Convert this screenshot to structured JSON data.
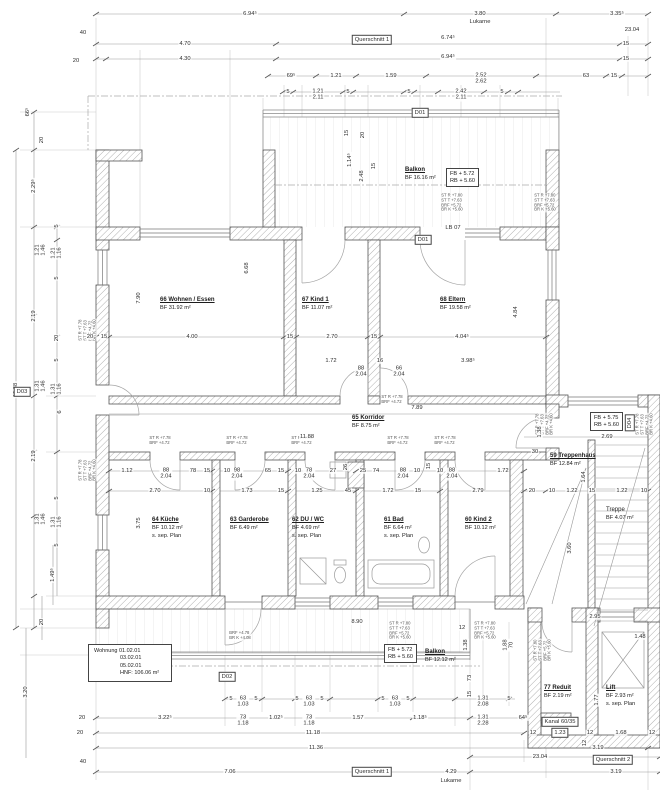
{
  "drawing": {
    "rooms": {
      "balkon_top": {
        "name": "Balkon",
        "area": "BF 16.16 m²"
      },
      "wohnen": {
        "name": "66 Wohnen / Essen",
        "area": "BF 31.92 m²"
      },
      "kind1": {
        "name": "67 Kind 1",
        "area": "BF 11.07 m²"
      },
      "eltern": {
        "name": "68 Eltern",
        "area": "BF 19.58 m²"
      },
      "korridor": {
        "name": "65 Korridor",
        "area": "BF 8.75 m²"
      },
      "kueche": {
        "name": "64 Küche",
        "area": "BF 10.12 m²",
        "note": "s. sep. Plan"
      },
      "garderobe": {
        "name": "63 Garderobe",
        "area": "BF 6.49 m²"
      },
      "duwc": {
        "name": "62 DU / WC",
        "area": "BF 4.69 m²",
        "note": "s. sep. Plan"
      },
      "bad": {
        "name": "61 Bad",
        "area": "BF 6.64 m²",
        "note": "s. sep. Plan"
      },
      "kind2": {
        "name": "60 Kind 2",
        "area": "BF 10.12 m²"
      },
      "treppenhaus": {
        "name": "59 Treppenhaus",
        "area": "BF 12.84 m²"
      },
      "treppe": {
        "name": "Treppe",
        "area": "BF 4.07 m²"
      },
      "balkon_bottom": {
        "name": "Balkon",
        "area": "BF 12.12 m²"
      },
      "reduit": {
        "name": "77 Reduit",
        "area": "BF 2.19 m²"
      },
      "lift": {
        "name": "Lift",
        "area": "BF 2.93 m²",
        "note": "s. sep. Plan"
      }
    },
    "levels": {
      "top": {
        "fb": "FB  + 5.72",
        "rb": "RB  + 5.60"
      },
      "right": {
        "fb": "FB  + 5.75",
        "rb": "RB  + 5.60"
      },
      "bottom": {
        "fb": "FB  + 5.72",
        "rb": "RB  + 5.60"
      }
    },
    "apartment": {
      "l1": "Wohnung  01.02.01",
      "l2": "03.02.01",
      "l3": "05.02.01",
      "l4": "HNF:  106.06 m²"
    },
    "colors": {
      "wall_line": "#555555",
      "hatch": "#8f8f8f",
      "chain": "#9a9a9a",
      "text": "#2e2e2e"
    },
    "dims": [
      {
        "t": "6.94⁵",
        "x": 250,
        "y": 14
      },
      {
        "t": "3.80",
        "x": 480,
        "y": 14
      },
      {
        "t": "Lukarne",
        "x": 480,
        "y": 22
      },
      {
        "t": "3.35⁵",
        "x": 617,
        "y": 14
      },
      {
        "t": "23.04",
        "x": 632,
        "y": 30
      },
      {
        "t": "40",
        "x": 83,
        "y": 33
      },
      {
        "t": "4.70",
        "x": 185,
        "y": 44
      },
      {
        "t": "Querschnitt 1",
        "x": 372,
        "y": 40,
        "box": true
      },
      {
        "t": "6.74⁵",
        "x": 448,
        "y": 38
      },
      {
        "t": "15",
        "x": 626,
        "y": 44
      },
      {
        "t": "20",
        "x": 76,
        "y": 61
      },
      {
        "t": "4.30",
        "x": 185,
        "y": 59
      },
      {
        "t": "6.94⁵",
        "x": 448,
        "y": 57
      },
      {
        "t": "15",
        "x": 626,
        "y": 59
      },
      {
        "t": "69⁵",
        "x": 291,
        "y": 76
      },
      {
        "t": "1.21",
        "x": 336,
        "y": 76
      },
      {
        "t": "1.59",
        "x": 391,
        "y": 76
      },
      {
        "t": "2.52",
        "t2": "2.62",
        "x": 481,
        "y": 79
      },
      {
        "t": "63",
        "x": 586,
        "y": 76
      },
      {
        "t": "15",
        "x": 614,
        "y": 76
      },
      {
        "t": "5",
        "x": 288,
        "y": 92
      },
      {
        "t": "1.21",
        "t2": "2.11",
        "x": 318,
        "y": 95
      },
      {
        "t": "5",
        "x": 348,
        "y": 92
      },
      {
        "t": "5",
        "x": 409,
        "y": 92
      },
      {
        "t": "2.42",
        "t2": "2.11",
        "x": 461,
        "y": 95
      },
      {
        "t": "5",
        "x": 502,
        "y": 92
      },
      {
        "t": "D01",
        "x": 420,
        "y": 113,
        "box": true
      },
      {
        "t": "15",
        "x": 347,
        "y": 133,
        "v": true
      },
      {
        "t": "20",
        "x": 363,
        "y": 135,
        "v": true
      },
      {
        "t": "1.14⁵",
        "x": 350,
        "y": 160,
        "v": true
      },
      {
        "t": "2.48",
        "x": 362,
        "y": 176,
        "v": true
      },
      {
        "t": "15",
        "x": 374,
        "y": 166,
        "v": true
      },
      {
        "t": "LB 07",
        "x": 453,
        "y": 228
      },
      {
        "t": "D01",
        "x": 423,
        "y": 240,
        "box": true
      },
      {
        "t": "66⁵",
        "x": 28,
        "y": 112,
        "v": true
      },
      {
        "t": "20",
        "x": 42,
        "y": 140,
        "v": true
      },
      {
        "t": "2.29⁵",
        "x": 34,
        "y": 186,
        "v": true
      },
      {
        "t": "5",
        "x": 57,
        "y": 226,
        "v": true
      },
      {
        "t": "1.21",
        "t2": "1.46",
        "x": 41,
        "y": 250,
        "v": true
      },
      {
        "t": "1.21",
        "t2": "1.16",
        "x": 57,
        "y": 253,
        "v": true
      },
      {
        "t": "5",
        "x": 57,
        "y": 278,
        "v": true
      },
      {
        "t": "2.19",
        "x": 34,
        "y": 316,
        "v": true
      },
      {
        "t": "12.88",
        "x": 16,
        "y": 390,
        "v": true
      },
      {
        "t": "20",
        "x": 57,
        "y": 338,
        "v": true
      },
      {
        "t": "5",
        "x": 57,
        "y": 360,
        "v": true
      },
      {
        "t": "1.31",
        "t2": "1.46",
        "x": 41,
        "y": 386,
        "v": true
      },
      {
        "t": "1.31",
        "t2": "1.16",
        "x": 57,
        "y": 389,
        "v": true
      },
      {
        "t": "D03",
        "x": 22,
        "y": 392,
        "box": true
      },
      {
        "t": "6",
        "x": 60,
        "y": 412,
        "v": true
      },
      {
        "t": "2.19",
        "x": 34,
        "y": 456,
        "v": true
      },
      {
        "t": "5",
        "x": 57,
        "y": 498,
        "v": true
      },
      {
        "t": "1.31",
        "t2": "1.46",
        "x": 41,
        "y": 519,
        "v": true
      },
      {
        "t": "1.31",
        "t2": "1.16",
        "x": 57,
        "y": 522,
        "v": true
      },
      {
        "t": "5",
        "x": 57,
        "y": 545,
        "v": true
      },
      {
        "t": "1.49⁵",
        "x": 53,
        "y": 575,
        "v": true
      },
      {
        "t": "20",
        "x": 42,
        "y": 622,
        "v": true
      },
      {
        "t": "3.20",
        "x": 26,
        "y": 692,
        "v": true
      },
      {
        "t": "7.90",
        "x": 139,
        "y": 298,
        "v": true
      },
      {
        "t": "6.68",
        "x": 247,
        "y": 268,
        "v": true
      },
      {
        "t": "4.84",
        "x": 516,
        "y": 312,
        "v": true
      },
      {
        "t": "20",
        "x": 90,
        "y": 337
      },
      {
        "t": "15",
        "x": 104,
        "y": 337
      },
      {
        "t": "4.00",
        "x": 192,
        "y": 337
      },
      {
        "t": "15",
        "x": 290,
        "y": 337
      },
      {
        "t": "2.70",
        "x": 332,
        "y": 337
      },
      {
        "t": "15",
        "x": 374,
        "y": 337
      },
      {
        "t": "4.04⁵",
        "x": 462,
        "y": 337
      },
      {
        "t": "1.72",
        "x": 331,
        "y": 361
      },
      {
        "t": "88",
        "t2": "2.04",
        "x": 361,
        "y": 372
      },
      {
        "t": "16",
        "x": 380,
        "y": 361
      },
      {
        "t": "66",
        "t2": "2.04",
        "x": 399,
        "y": 372
      },
      {
        "t": "3.98⁵",
        "x": 468,
        "y": 361
      },
      {
        "t": "7.89",
        "x": 417,
        "y": 408
      },
      {
        "t": "11.88",
        "x": 307,
        "y": 437
      },
      {
        "t": "1.12",
        "x": 127,
        "y": 471
      },
      {
        "t": "88",
        "t2": "2.04",
        "x": 166,
        "y": 474
      },
      {
        "t": "78",
        "x": 193,
        "y": 471
      },
      {
        "t": "15",
        "x": 207,
        "y": 471
      },
      {
        "t": "10",
        "x": 227,
        "y": 471
      },
      {
        "t": "98",
        "t2": "2.04",
        "x": 237,
        "y": 474
      },
      {
        "t": "65",
        "x": 268,
        "y": 471
      },
      {
        "t": "15",
        "x": 281,
        "y": 471
      },
      {
        "t": "10",
        "x": 298,
        "y": 471
      },
      {
        "t": "78",
        "t2": "2.04",
        "x": 309,
        "y": 474
      },
      {
        "t": "27",
        "x": 333,
        "y": 471
      },
      {
        "t": "26",
        "x": 346,
        "y": 467,
        "v": true
      },
      {
        "t": "25",
        "x": 363,
        "y": 471
      },
      {
        "t": "74",
        "x": 376,
        "y": 471
      },
      {
        "t": "88",
        "t2": "2.04",
        "x": 403,
        "y": 474
      },
      {
        "t": "10",
        "x": 417,
        "y": 471
      },
      {
        "t": "15",
        "x": 429,
        "y": 466,
        "v": true
      },
      {
        "t": "10",
        "x": 440,
        "y": 471
      },
      {
        "t": "88",
        "t2": "2.04",
        "x": 452,
        "y": 474
      },
      {
        "t": "1.72",
        "x": 503,
        "y": 471
      },
      {
        "t": "30",
        "x": 535,
        "y": 452
      },
      {
        "t": "2.70",
        "x": 155,
        "y": 491
      },
      {
        "t": "10",
        "x": 207,
        "y": 491
      },
      {
        "t": "1.73",
        "x": 247,
        "y": 491
      },
      {
        "t": "15",
        "x": 281,
        "y": 491
      },
      {
        "t": "1.25",
        "x": 317,
        "y": 491
      },
      {
        "t": "45",
        "x": 348,
        "y": 491
      },
      {
        "t": "1.72",
        "x": 388,
        "y": 491
      },
      {
        "t": "15",
        "x": 418,
        "y": 491
      },
      {
        "t": "2.79",
        "x": 478,
        "y": 491
      },
      {
        "t": "20",
        "x": 532,
        "y": 491
      },
      {
        "t": "10",
        "x": 552,
        "y": 491
      },
      {
        "t": "1.22",
        "x": 572,
        "y": 491
      },
      {
        "t": "15",
        "x": 592,
        "y": 491
      },
      {
        "t": "1.22",
        "x": 622,
        "y": 491
      },
      {
        "t": "10",
        "x": 644,
        "y": 491
      },
      {
        "t": "1.38",
        "x": 540,
        "y": 432,
        "v": true
      },
      {
        "t": "2.69",
        "x": 607,
        "y": 437
      },
      {
        "t": "D04",
        "x": 630,
        "y": 423,
        "v": true,
        "box": true
      },
      {
        "t": "1.64",
        "x": 584,
        "y": 477,
        "v": true
      },
      {
        "t": "3.60",
        "x": 570,
        "y": 548,
        "v": true
      },
      {
        "t": "3.75",
        "x": 139,
        "y": 523,
        "v": true
      },
      {
        "t": "8.90",
        "x": 357,
        "y": 622
      },
      {
        "t": "12",
        "x": 462,
        "y": 628
      },
      {
        "t": "2.95",
        "x": 595,
        "y": 617
      },
      {
        "t": "1.48",
        "x": 640,
        "y": 637
      },
      {
        "t": "1.38",
        "x": 466,
        "y": 645,
        "v": true
      },
      {
        "t": "1.88",
        "t2": "70",
        "x": 509,
        "y": 645,
        "v": true
      },
      {
        "t": "73",
        "x": 470,
        "y": 678,
        "v": true
      },
      {
        "t": "15",
        "x": 470,
        "y": 694,
        "v": true
      },
      {
        "t": "1.77",
        "x": 597,
        "y": 700,
        "v": true
      },
      {
        "t": "Kanal 60/35",
        "x": 560,
        "y": 722,
        "box": true
      },
      {
        "t": "12",
        "x": 533,
        "y": 733
      },
      {
        "t": "1.23",
        "x": 560,
        "y": 733,
        "box": true
      },
      {
        "t": "12",
        "x": 590,
        "y": 733
      },
      {
        "t": "1.68",
        "x": 621,
        "y": 733
      },
      {
        "t": "12",
        "x": 652,
        "y": 733
      },
      {
        "t": "12",
        "x": 585,
        "y": 743,
        "v": true
      },
      {
        "t": "5",
        "x": 231,
        "y": 699
      },
      {
        "t": "63",
        "t2": "1.03",
        "x": 243,
        "y": 702
      },
      {
        "t": "5",
        "x": 256,
        "y": 699
      },
      {
        "t": "5",
        "x": 297,
        "y": 699
      },
      {
        "t": "63",
        "t2": "1.03",
        "x": 309,
        "y": 702
      },
      {
        "t": "5",
        "x": 322,
        "y": 699
      },
      {
        "t": "5",
        "x": 383,
        "y": 699
      },
      {
        "t": "63",
        "t2": "1.03",
        "x": 395,
        "y": 702
      },
      {
        "t": "5",
        "x": 408,
        "y": 699
      },
      {
        "t": "1.31",
        "t2": "2.08",
        "x": 483,
        "y": 702
      },
      {
        "t": "5",
        "x": 509,
        "y": 699
      },
      {
        "t": "20",
        "x": 82,
        "y": 718
      },
      {
        "t": "3.22⁵",
        "x": 165,
        "y": 718
      },
      {
        "t": "73",
        "t2": "1.18",
        "x": 243,
        "y": 721
      },
      {
        "t": "1.02⁵",
        "x": 276,
        "y": 718
      },
      {
        "t": "73",
        "t2": "1.18",
        "x": 309,
        "y": 721
      },
      {
        "t": "1.57",
        "x": 358,
        "y": 718
      },
      {
        "t": "1.18⁵",
        "x": 420,
        "y": 718
      },
      {
        "t": "1.31",
        "t2": "2.28",
        "x": 483,
        "y": 721
      },
      {
        "t": "64⁵",
        "x": 523,
        "y": 718
      },
      {
        "t": "20",
        "x": 80,
        "y": 733
      },
      {
        "t": "11.18",
        "x": 313,
        "y": 733
      },
      {
        "t": "11.36",
        "x": 316,
        "y": 748
      },
      {
        "t": "3.19",
        "x": 598,
        "y": 748
      },
      {
        "t": "23.04",
        "x": 540,
        "y": 757
      },
      {
        "t": "40",
        "x": 83,
        "y": 762
      },
      {
        "t": "7.06",
        "x": 230,
        "y": 772
      },
      {
        "t": "Querschnitt 1",
        "x": 372,
        "y": 772,
        "box": true
      },
      {
        "t": "4.29",
        "x": 451,
        "y": 772
      },
      {
        "t": "Lukarne",
        "x": 451,
        "y": 781
      },
      {
        "t": "Querschnitt 2",
        "x": 613,
        "y": 760,
        "box": true
      },
      {
        "t": "3.19",
        "x": 616,
        "y": 772
      },
      {
        "t": "D02",
        "x": 227,
        "y": 677,
        "box": true
      }
    ],
    "notes": [
      {
        "x": 452,
        "y": 203,
        "lines": [
          "ST R +7.80",
          "ST T +7.63",
          "BRF +5.72",
          "BR K +5.60"
        ]
      },
      {
        "x": 545,
        "y": 203,
        "lines": [
          "ST R +7.80",
          "ST T +7.63",
          "BRF +5.72",
          "BR K +5.60"
        ]
      },
      {
        "x": 88,
        "y": 330,
        "v": true,
        "lines": [
          "ST R +7.78",
          "ST T +7.63",
          "BRF +4.72",
          "BR K +4.60"
        ]
      },
      {
        "x": 88,
        "y": 470,
        "v": true,
        "lines": [
          "ST R +7.78",
          "ST T +7.63",
          "BRF +4.72",
          "BR K +4.60"
        ]
      },
      {
        "x": 545,
        "y": 424,
        "v": true,
        "lines": [
          "ST R +7.78",
          "ST T +7.63",
          "BRF +4.72",
          "BR K +4.60"
        ]
      },
      {
        "x": 645,
        "y": 424,
        "v": true,
        "lines": [
          "ST R +7.78",
          "ST T +7.63",
          "BRF +4.72",
          "BR K +4.60"
        ]
      },
      {
        "x": 400,
        "y": 631,
        "lines": [
          "ST R +7.80",
          "ST T +7.63",
          "BRF +5.72",
          "BR K +5.60"
        ]
      },
      {
        "x": 485,
        "y": 631,
        "lines": [
          "ST R +7.80",
          "ST T +7.63",
          "BRF +5.72",
          "BR K +5.60"
        ]
      },
      {
        "x": 543,
        "y": 650,
        "v": true,
        "lines": [
          "ST R +7.80",
          "ST T +7.63",
          "BRF +5.72",
          "BR K +5.60"
        ]
      },
      {
        "x": 240,
        "y": 636,
        "lines": [
          "BRF +4.78",
          "BR K +4.08"
        ]
      },
      {
        "x": 160,
        "y": 441,
        "lines": [
          "ST R  +7.78",
          "BRF  +4.72"
        ]
      },
      {
        "x": 237,
        "y": 441,
        "lines": [
          "ST R  +7.78",
          "BRF  +4.72"
        ]
      },
      {
        "x": 302,
        "y": 441,
        "lines": [
          "ST R  +7.78",
          "BRF  +4.72"
        ]
      },
      {
        "x": 398,
        "y": 441,
        "lines": [
          "ST R  +7.78",
          "BRF  +4.72"
        ]
      },
      {
        "x": 445,
        "y": 441,
        "lines": [
          "ST R  +7.78",
          "BRF  +4.72"
        ]
      },
      {
        "x": 392,
        "y": 400,
        "lines": [
          "ST R  +7.78",
          "BRF  +4.72"
        ]
      }
    ]
  }
}
